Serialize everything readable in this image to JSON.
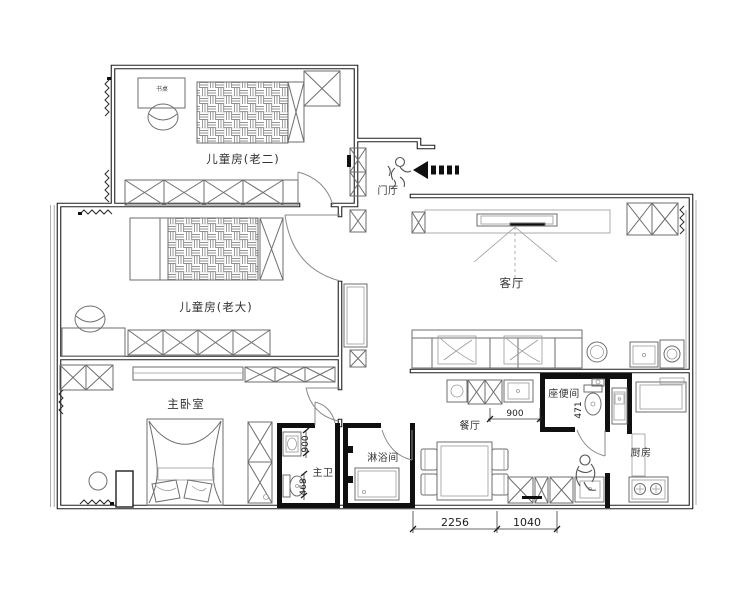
{
  "plan": {
    "rooms": [
      {
        "id": "kids-room-2",
        "label": "儿童房(老二)"
      },
      {
        "id": "kids-room-1",
        "label": "儿童房(老大)"
      },
      {
        "id": "master-bedroom",
        "label": "主卧室"
      },
      {
        "id": "master-bathroom",
        "label": "主卫"
      },
      {
        "id": "shower-room",
        "label": "淋浴间"
      },
      {
        "id": "entry-hall",
        "label": "门厅"
      },
      {
        "id": "living-room",
        "label": "客厅"
      },
      {
        "id": "dining-room",
        "label": "餐厅"
      },
      {
        "id": "toilet-room",
        "label": "座便间"
      },
      {
        "id": "kitchen",
        "label": "厨房"
      }
    ],
    "furniture_labels": {
      "desk": "书桌"
    },
    "dimensions": {
      "bath_vanity_width": "900",
      "bath_toilet_width": "468",
      "toilet_room_width": "471",
      "dining_cabinet_width": "900",
      "bottom_segment_left": "2256",
      "bottom_segment_right": "1040"
    },
    "colors": {
      "wall": "#1a1a1a",
      "furniture_line": "#6e6e6e",
      "text": "#333333"
    }
  }
}
